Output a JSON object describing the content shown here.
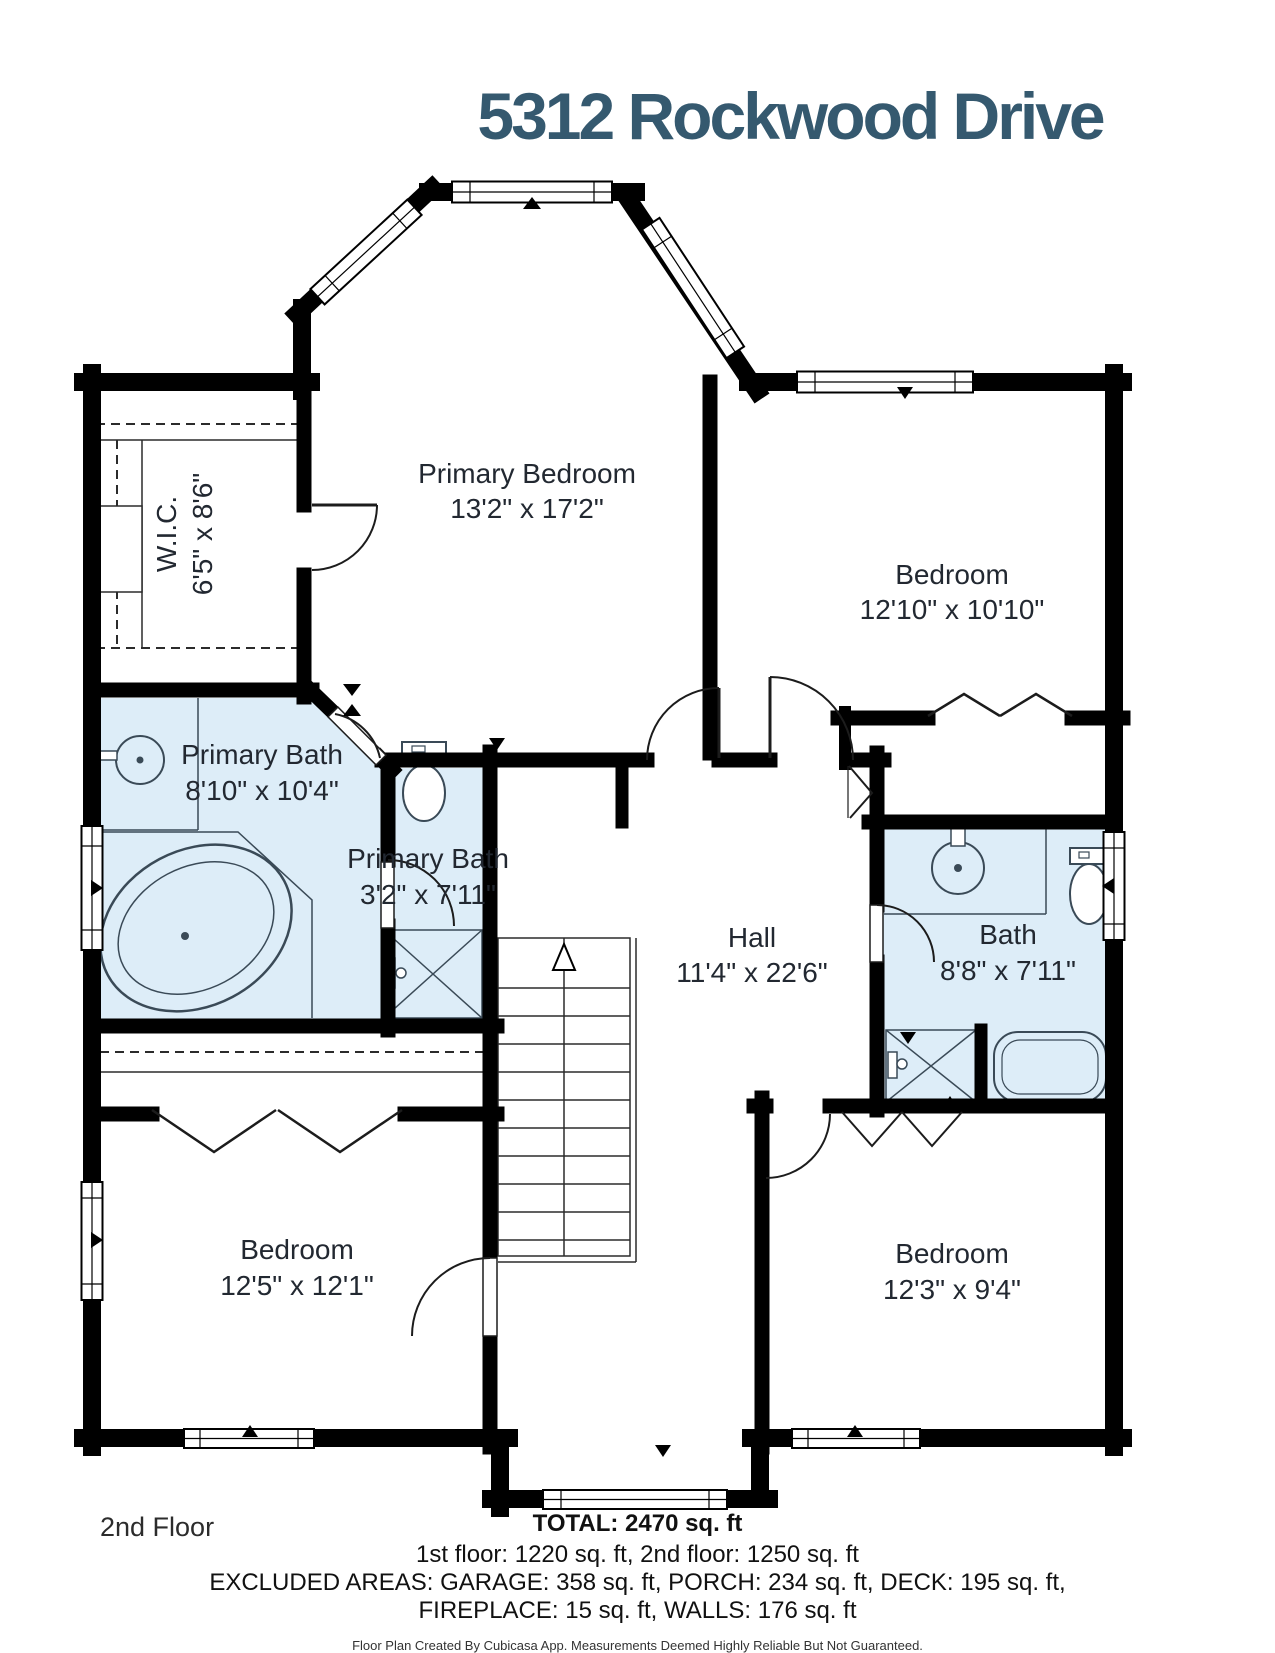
{
  "title": "5312 Rockwood Drive",
  "floor_label": "2nd Floor",
  "summary": {
    "total": "TOTAL: 2470 sq. ft",
    "floors": "1st floor: 1220 sq. ft, 2nd floor: 1250 sq. ft",
    "excluded_1": "EXCLUDED AREAS: GARAGE: 358 sq. ft, PORCH: 234 sq. ft, DECK: 195 sq. ft,",
    "excluded_2": "FIREPLACE: 15 sq. ft, WALLS: 176 sq. ft",
    "disclaimer": "Floor Plan Created By Cubicasa App. Measurements Deemed Highly Reliable But Not Guaranteed."
  },
  "rooms": {
    "primary_bedroom": {
      "name": "Primary Bedroom",
      "dims": "13'2\" x 17'2\""
    },
    "wic": {
      "name": "W.I.C.",
      "dims": "6'5\" x 8'6\""
    },
    "bedroom_tr": {
      "name": "Bedroom",
      "dims": "12'10\" x 10'10\""
    },
    "primary_bath": {
      "name": "Primary Bath",
      "dims": "8'10\" x 10'4\""
    },
    "primary_bath2": {
      "name": "Primary Bath",
      "dims": "3'2\" x 7'11\""
    },
    "hall": {
      "name": "Hall",
      "dims": "11'4\" x 22'6\""
    },
    "bath": {
      "name": "Bath",
      "dims": "8'8\" x 7'11\""
    },
    "bedroom_bl": {
      "name": "Bedroom",
      "dims": "12'5\" x 12'1\""
    },
    "bedroom_br": {
      "name": "Bedroom",
      "dims": "12'3\" x 9'4\""
    }
  },
  "colors": {
    "title": "#35596f",
    "bath_fill": "#ddedf8",
    "wall": "#000000",
    "fixture": "#3a4a57",
    "label": "#222831"
  }
}
